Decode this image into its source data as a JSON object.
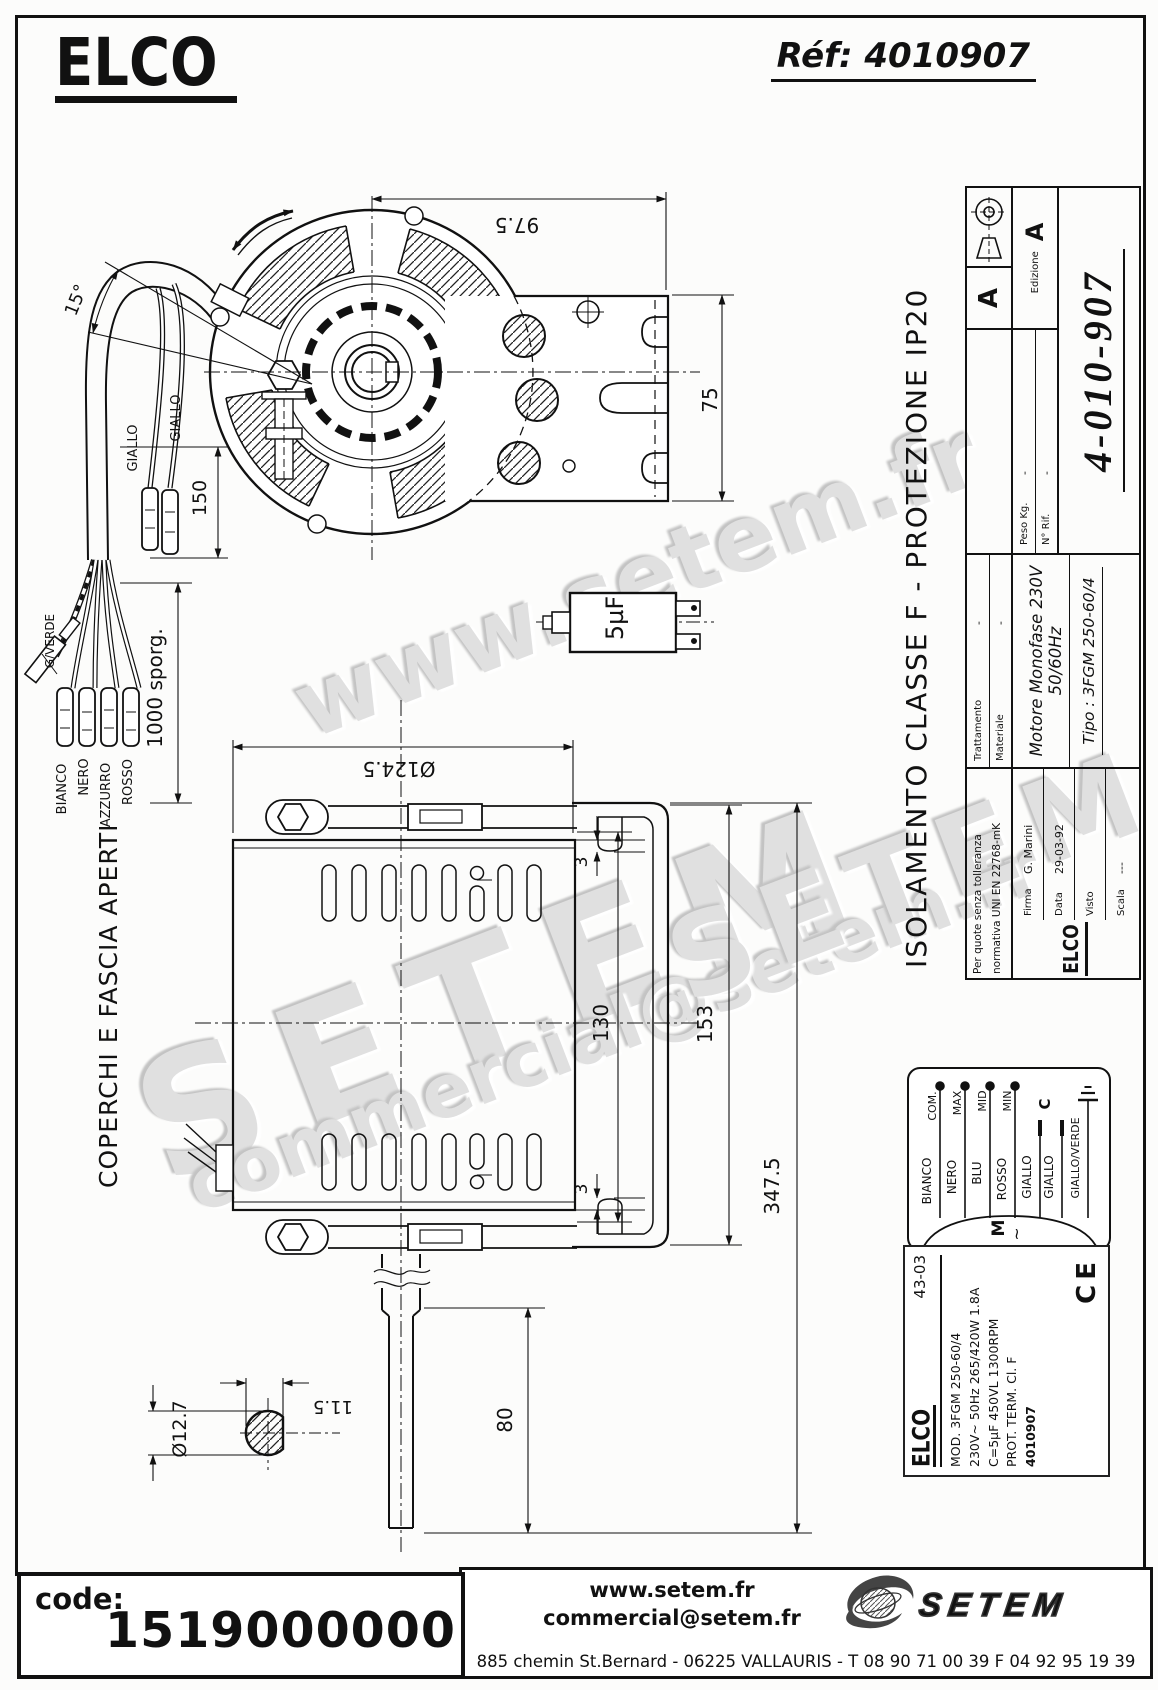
{
  "header": {
    "logo": "ELCO",
    "ref": "Réf: 4010907"
  },
  "front_view": {
    "dim_width": "97.5",
    "dim_height": "75",
    "dim_angle": "15°",
    "dim_wire_len": "150",
    "dim_cable_len": "1000 sporg.",
    "wire_yellow_1": "GIALLO",
    "wire_yellow_2": "GIALLO",
    "wire_gv": "G/VERDE",
    "wire_white": "BIANCO",
    "wire_black": "NERO",
    "wire_blue": "AZZURRO",
    "wire_red": "ROSSO"
  },
  "capacitor": {
    "value": "5µF"
  },
  "side_view": {
    "note": "COPERCHI E FASCIA APERTI",
    "dim_diameter": "Ø124.5",
    "dim_gap_top": "3",
    "dim_gap_bottom": "3",
    "dim_body": "130",
    "dim_bracket": "153",
    "dim_total": "347.5",
    "dim_shaft": "80",
    "dim_shaft_dia": "Ø12.7",
    "dim_shaft_flat": "11.5"
  },
  "title_block": {
    "iso_class": "ISOLAMENTO CLASSE F  -  PROTEZIONE IP20",
    "tol_line1": "Per quote senza tolleranza",
    "tol_line2": "normativa UNI EN 22768-mK",
    "trattamento_label": "Trattamento",
    "trattamento_value": "-",
    "materiale_label": "Materiale",
    "materiale_value": "-",
    "motor_desc": "Motore Monofase  230V  50/60Hz",
    "tipo": "Tipo :  3FGM 250-60/4",
    "firma_label": "Firma",
    "firma_value": "G. Marini",
    "data_label": "Data",
    "data_value": "29-03-92",
    "visto_label": "Visto",
    "visto_value": "",
    "scala_label": "Scala",
    "scala_value": "---",
    "peso_label": "Peso Kg.",
    "peso_value": "-",
    "rif_label": "N° Rif.",
    "rif_value": "-",
    "edizione_label": "Edizione",
    "edizione_value": "A",
    "rev": "A",
    "number": "4-010-907",
    "logo": "ELCO"
  },
  "wiring": {
    "tap_com": "COM.",
    "tap_max": "MAX",
    "tap_mid": "MID",
    "tap_min": "MIN",
    "w1": "BIANCO",
    "w2": "NERO",
    "w3": "BLU",
    "w4": "ROSSO",
    "w5": "GIALLO",
    "w6": "GIALLO",
    "w7": "GIALLO/VERDE",
    "motor": "M",
    "phase": "~",
    "cap": "C"
  },
  "nameplate": {
    "logo": "ELCO",
    "date_code": "43-03",
    "line1": "MOD.  3FGM 250-60/4",
    "line2": "230V~ 50Hz  265/420W  1.8A",
    "line3": "C=5µF 450VL   1300RPM",
    "line4": "PROT. TERM.   Cl. F",
    "line5": "4010907",
    "ce": "CE"
  },
  "footer": {
    "code_label": "code:",
    "code_value": "1519000000",
    "site": "www.setem.fr",
    "email": "commercial@setem.fr",
    "address": "885 chemin St.Bernard  -  06225 VALLAURIS  -  T 08 90 71 00 39   F 04 92 95 19 39",
    "brand": "SETEM"
  },
  "watermarks": {
    "wm1": "www.setem.fr",
    "wm2": "SETEM",
    "wm3": "commercial@setem.fr",
    "wm4": "SETEM"
  },
  "colors": {
    "line": "#111111",
    "watermark": "#e0e0e0"
  }
}
